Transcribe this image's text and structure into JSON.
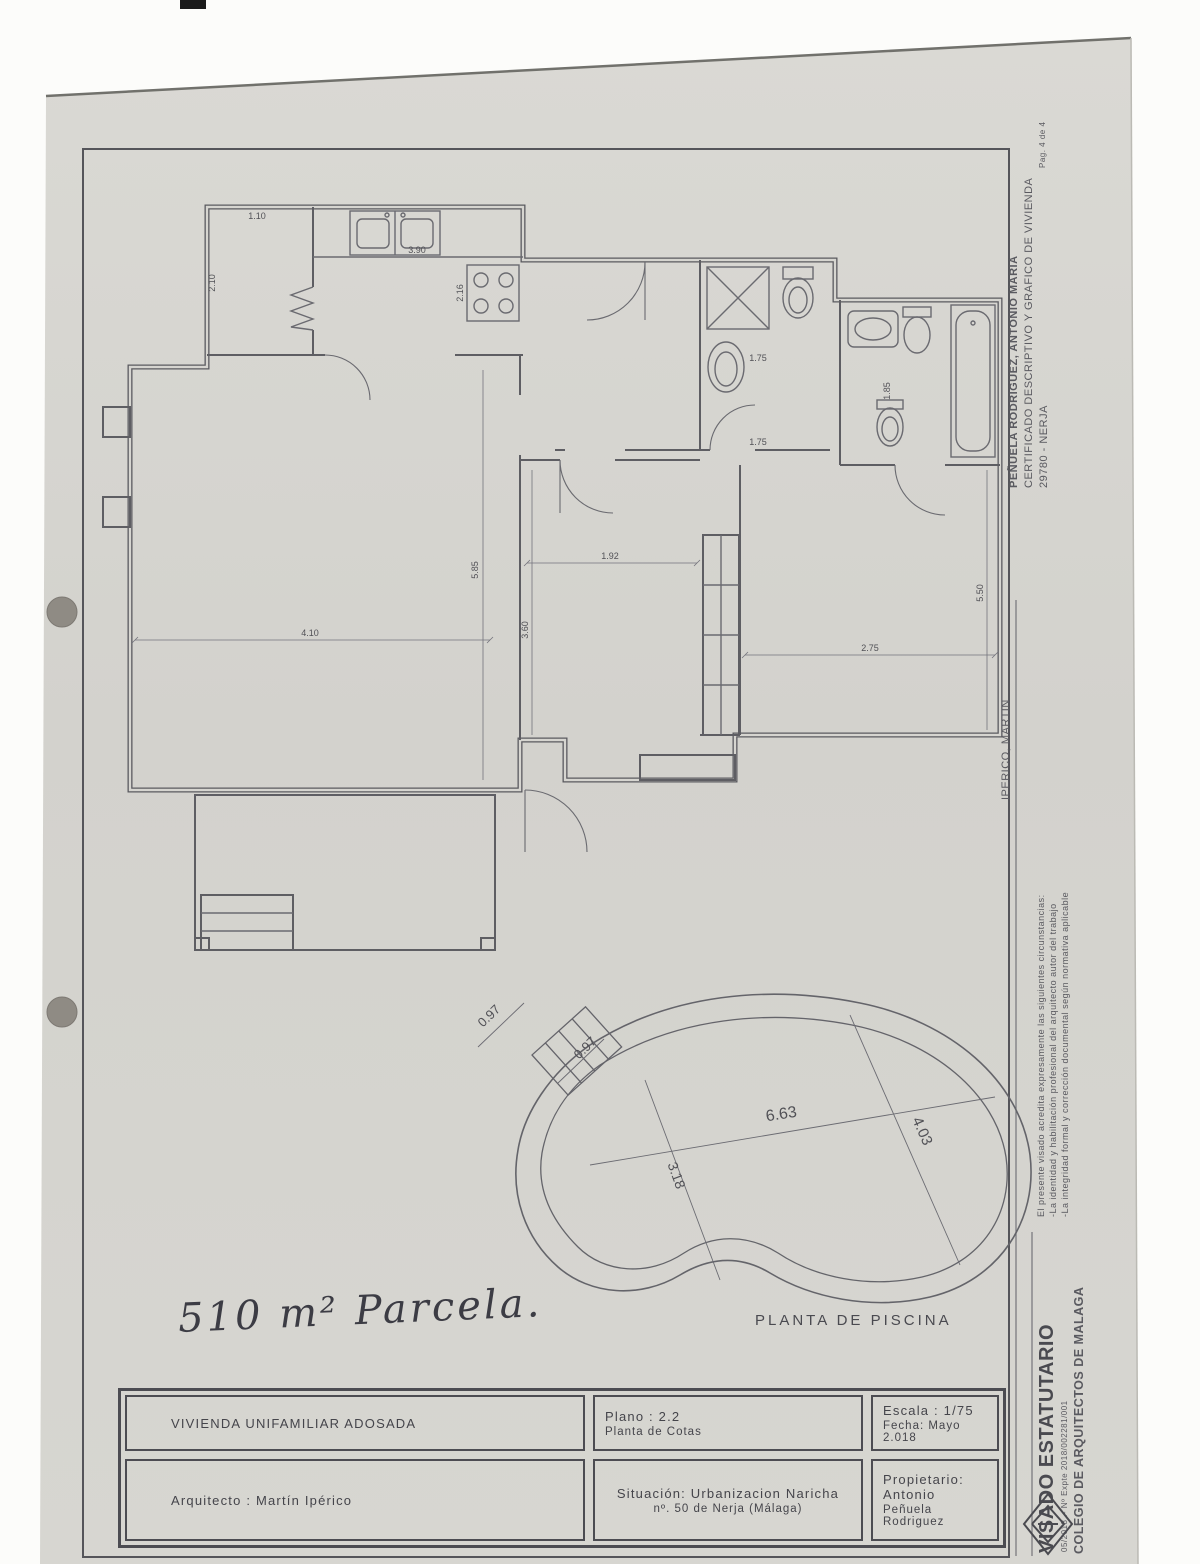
{
  "page": {
    "handwritten_note": "510 m² Parcela.",
    "colors": {
      "paper": "#d6d5d0",
      "ink": "#55555a"
    }
  },
  "plan": {
    "dims": {
      "d1": "1.10",
      "d2": "2.10",
      "d3": "3.90",
      "d4": "2.16",
      "d5": "4.10",
      "d6": "5.85",
      "d7": "1.92",
      "d8": "3.60",
      "d9": "2.75",
      "d10": "5.50",
      "d11": "1.75",
      "d12": "1.75",
      "d13": "1.85"
    }
  },
  "pool": {
    "label": "PLANTA DE PISCINA",
    "dims": {
      "steps_left": "0.97",
      "steps_right": "0.97",
      "length": "6.63",
      "width_right": "4.03",
      "width_left": "3.18"
    }
  },
  "titleblock": {
    "project": "VIVIENDA  UNIFAMILIAR  ADOSADA",
    "plano": "Plano : 2.2",
    "plano_sub": "Planta de Cotas",
    "escala": "Escala : 1/75",
    "fecha": "Fecha: Mayo 2.018",
    "arquitecto": "Arquitecto :    Martín  Ipérico",
    "situacion_1": "Situación:  Urbanizacion  Naricha",
    "situacion_2": "nº. 50 de Nerja (Málaga)",
    "propietario_1": "Propietario:  Antonio",
    "propietario_2": "Peñuela Rodriguez"
  },
  "margin": {
    "page_ref": "Pag. 4 de 4",
    "owner": "PEÑUELA RODRIGUEZ, ANTONIO MARIA",
    "cert": "CERTIFICADO DESCRIPTIVO Y GRAFICO DE VIVIENDA",
    "city": "29780 - NERJA",
    "architect": "IPERICO, MARTIN",
    "visado_1": "El presente visado acredita expresamente las siguientes circunstancias:",
    "visado_2": "-La identidad y habilitación profesional del arquitecto autor del trabajo",
    "visado_3": "-La integridad formal y corrección documental según normativa aplicable",
    "stamp_title": "VISADO ESTATUTARIO",
    "stamp_ref": "05/2018 .- Nº Expte 2018/002281/001",
    "stamp_org": "COLEGIO DE ARQUITECTOS DE MALAGA"
  }
}
